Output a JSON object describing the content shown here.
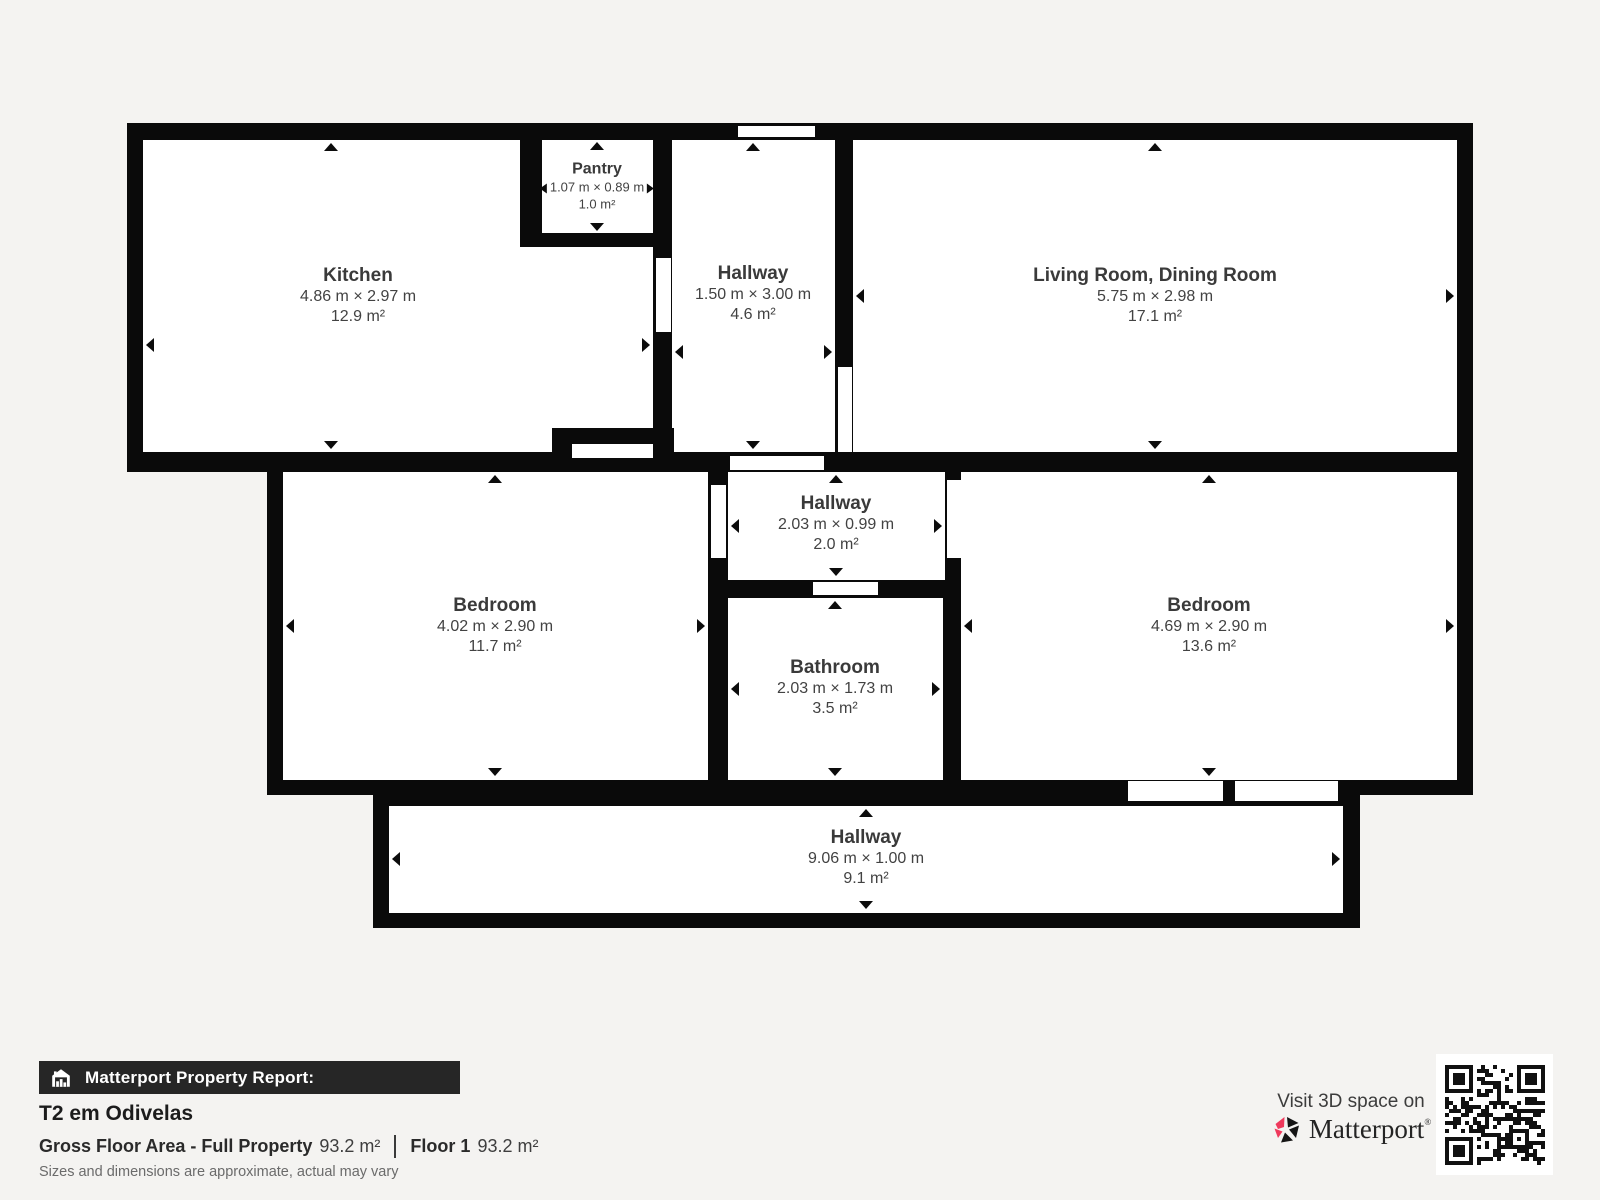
{
  "floorplan": {
    "rooms": [
      {
        "name": "Kitchen",
        "dims": "4.86 m × 2.97 m",
        "area": "12.9 m²"
      },
      {
        "name": "Pantry",
        "dims": "1.07 m × 0.89 m",
        "area": "1.0 m²"
      },
      {
        "name": "Hallway",
        "dims": "1.50 m × 3.00 m",
        "area": "4.6 m²"
      },
      {
        "name": "Living Room, Dining Room",
        "dims": "5.75 m × 2.98 m",
        "area": "17.1 m²"
      },
      {
        "name": "Bedroom",
        "dims": "4.02 m × 2.90 m",
        "area": "11.7 m²"
      },
      {
        "name": "Hallway",
        "dims": "2.03 m × 0.99 m",
        "area": "2.0 m²"
      },
      {
        "name": "Bathroom",
        "dims": "2.03 m × 1.73 m",
        "area": "3.5 m²"
      },
      {
        "name": "Bedroom",
        "dims": "4.69 m × 2.90 m",
        "area": "13.6 m²"
      },
      {
        "name": "Hallway",
        "dims": "9.06 m × 1.00 m",
        "area": "9.1 m²"
      }
    ]
  },
  "footer": {
    "report_label": "Matterport Property Report:",
    "property_title": "T2 em Odivelas",
    "gross_floor_area_label": "Gross Floor Area - Full Property",
    "gross_floor_area_value": "93.2 m²",
    "floor_label": "Floor 1",
    "floor_value": "93.2 m²",
    "disclaimer": "Sizes and dimensions are approximate, actual may vary",
    "visit_label": "Visit 3D space on",
    "brand": "Matterport",
    "brand_mark": "®"
  },
  "colors": {
    "background": "#f4f3f1",
    "wall": "#0a0a0a",
    "room_fill": "#ffffff",
    "label_text": "#3a3a3a",
    "banner_background": "#262626",
    "brand_pink": "#ef395c"
  }
}
